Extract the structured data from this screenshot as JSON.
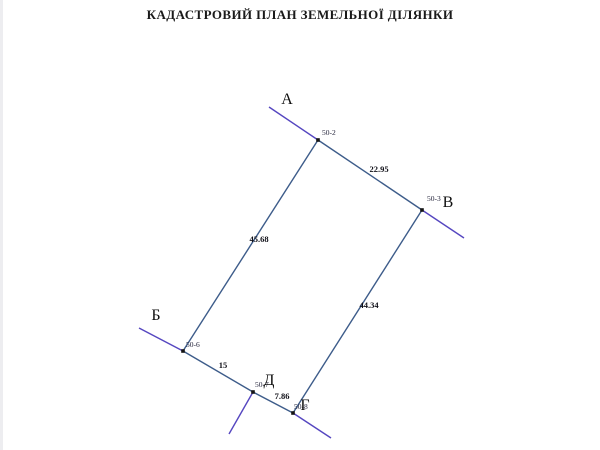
{
  "title": "КАДАСТРОВИЙ ПЛАН ЗЕМЕЛЬНОЇ ДІЛЯНКИ",
  "colors": {
    "boundary": "#3d5c8a",
    "extension": "#5546c0",
    "vertex": "#141414"
  },
  "plan": {
    "vertices": [
      {
        "name": "50-2",
        "x": 318,
        "y": 140,
        "label": {
          "x": 322,
          "y": 135,
          "anchor": "start"
        }
      },
      {
        "name": "50-3",
        "x": 422,
        "y": 210,
        "label": {
          "x": 427,
          "y": 201,
          "anchor": "start"
        }
      },
      {
        "name": "50-6",
        "x": 183,
        "y": 351,
        "label": {
          "x": 186,
          "y": 347,
          "anchor": "start"
        }
      },
      {
        "name": "50-7",
        "x": 253,
        "y": 392,
        "label": {
          "x": 255,
          "y": 387,
          "anchor": "start"
        }
      },
      {
        "name": "50-8",
        "x": 293,
        "y": 413,
        "label": {
          "x": 294,
          "y": 409,
          "anchor": "start"
        }
      }
    ],
    "boundaries": [
      {
        "from": "50-2",
        "to": "50-3",
        "length": "22.95",
        "label": {
          "x": 379,
          "y": 172
        }
      },
      {
        "from": "50-3",
        "to": "50-8",
        "length": "44.34",
        "label": {
          "x": 369,
          "y": 308
        }
      },
      {
        "from": "50-7",
        "to": "50-8",
        "length": "7.86",
        "label": {
          "x": 282,
          "y": 399
        }
      },
      {
        "from": "50-6",
        "to": "50-7",
        "length": "15",
        "label": {
          "x": 223,
          "y": 368
        }
      },
      {
        "from": "50-2",
        "to": "50-6",
        "length": "45.68",
        "label": {
          "x": 259,
          "y": 242
        }
      }
    ],
    "extensions": [
      {
        "name": "beyond-A",
        "x1": 269,
        "y1": 107,
        "x2": 318,
        "y2": 140
      },
      {
        "name": "beyond-V",
        "x1": 422,
        "y1": 210,
        "x2": 464,
        "y2": 238
      },
      {
        "name": "beyond-B",
        "x1": 139,
        "y1": 328,
        "x2": 183,
        "y2": 351
      },
      {
        "name": "below-D",
        "x1": 253,
        "y1": 392,
        "x2": 229,
        "y2": 434
      },
      {
        "name": "beyond-G",
        "x1": 293,
        "y1": 413,
        "x2": 331,
        "y2": 438
      }
    ],
    "letters": [
      {
        "text": "А",
        "x": 287,
        "y": 104
      },
      {
        "text": "Б",
        "x": 156,
        "y": 320
      },
      {
        "text": "В",
        "x": 448,
        "y": 207
      },
      {
        "text": "Г",
        "x": 305,
        "y": 410
      },
      {
        "text": "Д",
        "x": 269,
        "y": 385
      }
    ]
  }
}
